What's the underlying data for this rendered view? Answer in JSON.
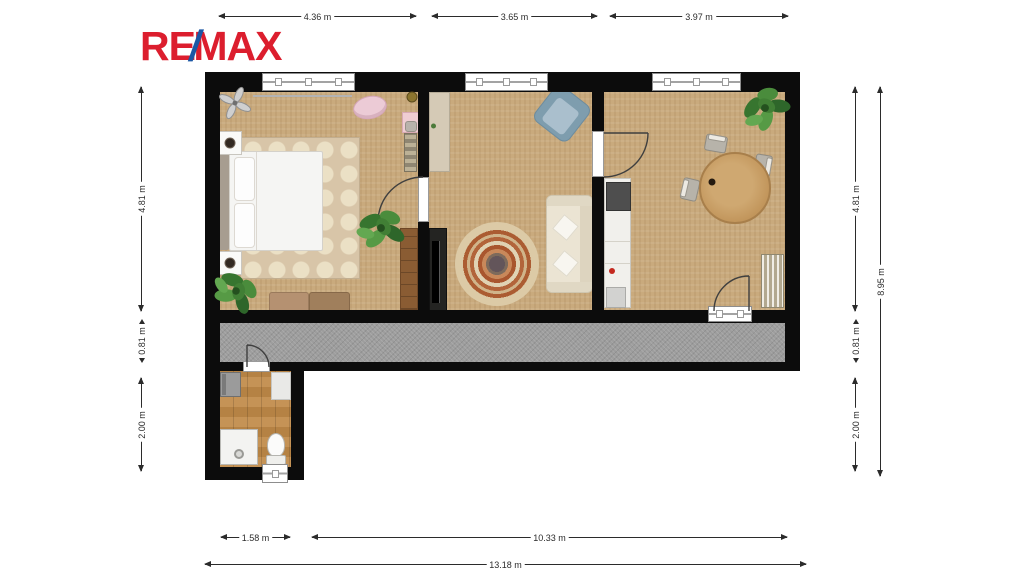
{
  "logo": {
    "re": "RE",
    "slash": "/",
    "max": "MAX"
  },
  "colors": {
    "brand_red": "#dc1e2e",
    "brand_blue": "#1b57a5",
    "wall": "#0c0c0c",
    "room_floor": "#c9aa7d",
    "balcony_floor": "#9d9d9d",
    "bathroom_floor": "#c08a48",
    "dimension_text": "#2b2b2b"
  },
  "dimensions": {
    "top": [
      "4.36 m",
      "3.65 m",
      "3.97 m"
    ],
    "left": [
      "4.81 m",
      "0.81 m",
      "2.00 m"
    ],
    "right": [
      "4.81 m",
      "0.81 m",
      "2.00 m"
    ],
    "right_total": "8.95 m",
    "bottom": [
      "1.58 m",
      "10.33 m"
    ],
    "bottom_total": "13.18 m"
  }
}
